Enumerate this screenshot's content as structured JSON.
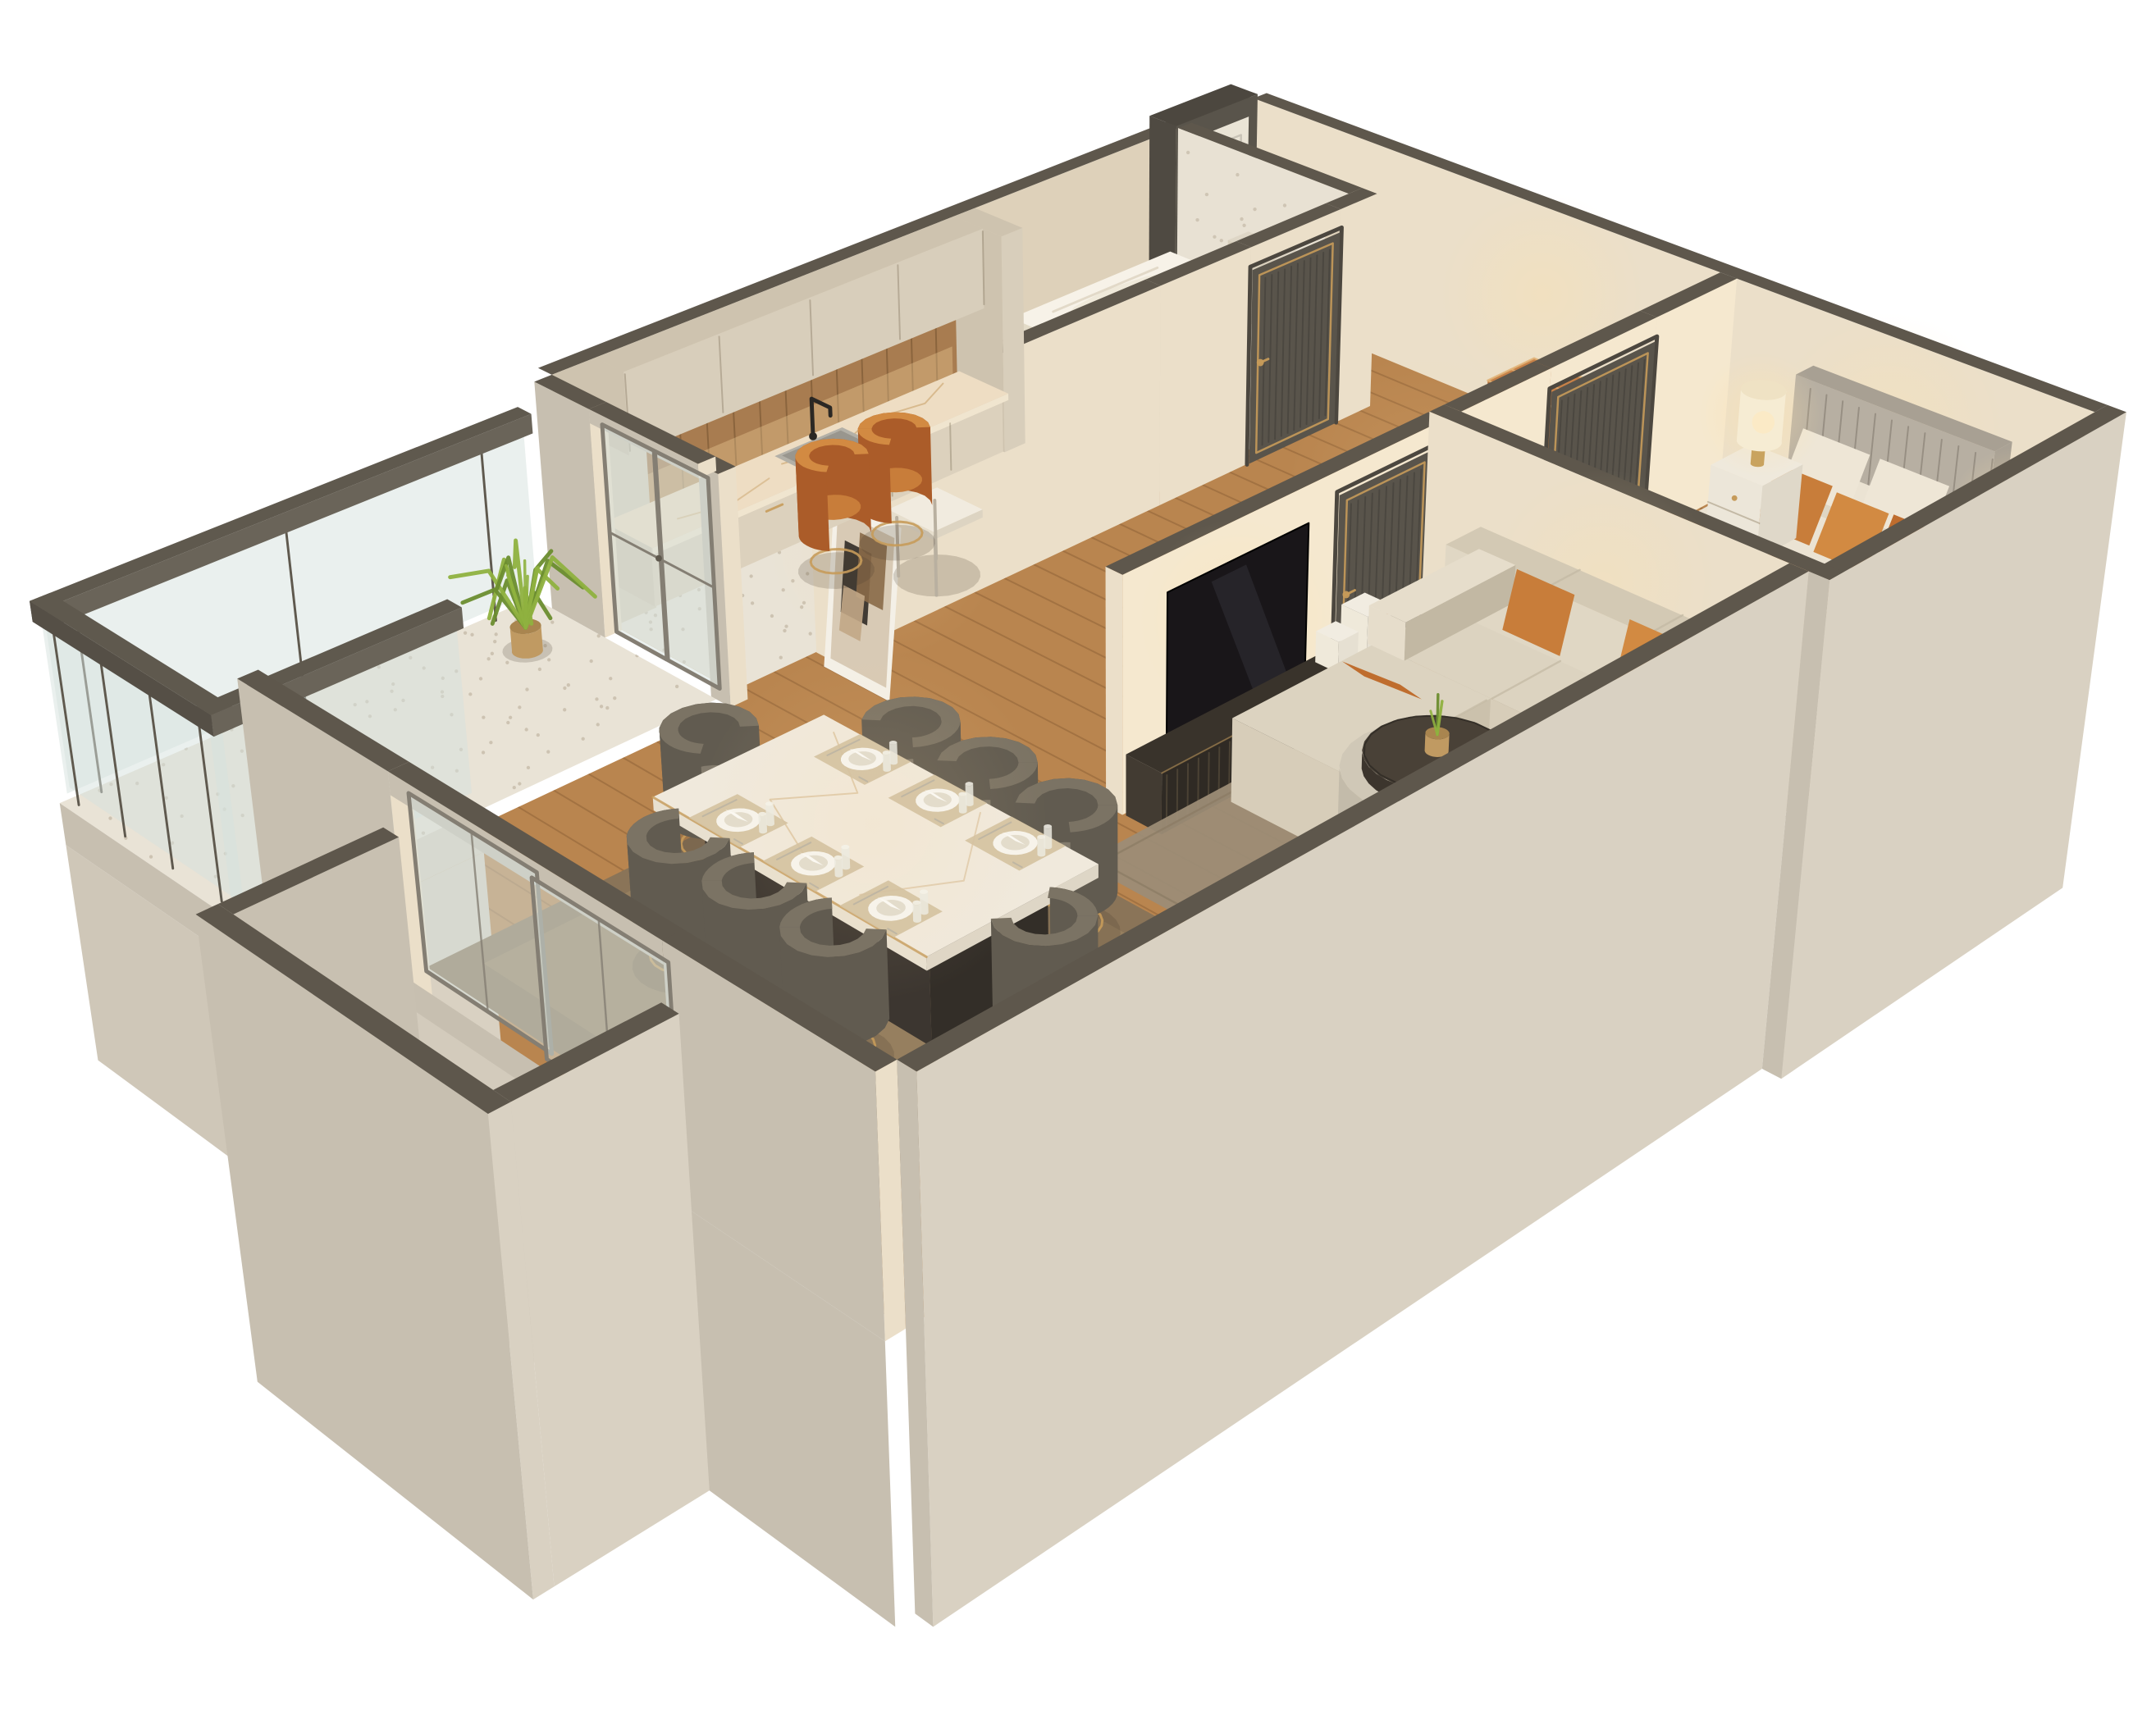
{
  "title": "3D isometric cutaway floor plan render of a one-bedroom apartment",
  "palette": {
    "bg": "#ffffff",
    "wallCap": "#5e574c",
    "extBright": "#d9d1c2",
    "extMid": "#c7bfb0",
    "extDeep": "#cfc7b8",
    "intWall": "#ebdfc9",
    "intWallLit": "#f5e8cf",
    "intWallDim": "#ded1ba",
    "wood": "#b9854f",
    "woodLine": "rgba(96,60,28,0.25)",
    "terrazzo": "#e9e3d6",
    "terrazzoDot": "#b6aa96",
    "rugBed": "#48423a",
    "rugBedLine": "#5f584c",
    "rugLiving": "#9c8c76",
    "rugDining": "#8a7458",
    "rugDiningLight": "#a18a66",
    "doorDark": "#59544b",
    "doorLine": "#49453e",
    "doorFrame": "#4c473f",
    "gold": "#c69b5a",
    "entryDoor": "#eae4d6",
    "glass": "rgba(214,226,222,0.5)",
    "glassFrame": "#847e73",
    "railDark": "#5f594e",
    "white": "#f7f2e8",
    "cream": "#efe9da",
    "marble": "#eeddc3",
    "marbleVein": "#c69d62",
    "counterFace": "#dcd1bd",
    "cabinet": "#d8cebb",
    "cabinetShade": "#cec3af",
    "cabinetLine": "rgba(95,78,55,0.28)",
    "backsplash": "#a87c50",
    "backsplashLine": "rgba(70,45,20,0.3)",
    "sink": "#b3b0a7",
    "sinkInner": "#99968e",
    "black": "#2b2824",
    "ottoman": "#b5713a",
    "ottomanTop": "#c68148",
    "ottomanShade": "#a2602c",
    "pipe": "#e2b478",
    "headboard": "#b7afa2",
    "headboardTop": "#a8a093",
    "headboardLine": "rgba(80,70,58,0.3)",
    "bedBase": "#a29a8c",
    "bedBaseShade": "#948c7e",
    "sheet": "#ebe3d3",
    "sheetShade": "#d9d0bd",
    "sheetDark": "#cfc6b2",
    "duvet": "#c4722f",
    "duvetShade": "#ad6428",
    "duvetDark": "#9d5a24",
    "duvetFold": "#d2823e",
    "pillowWhite": "#eee6d6",
    "pillowWhiteShade": "#dcd2bf",
    "orange1": "#c87d3a",
    "orange2": "#d28a42",
    "orange3": "#bf6d2e",
    "orangeChairSide": "#ab5c29",
    "nightstand": "#ece6d9",
    "nightstandShade": "#dfd8c9",
    "lampBase": "#c9a35f",
    "lampShade": "#f6ecd3",
    "lampShadeTop": "#efe2c4",
    "glow": "#ffe2aa",
    "sofa": "#dcd3c0",
    "sofaLight": "#e6ddcb",
    "sofaShade": "#cbc1ac",
    "sofaDark": "#c2b8a3",
    "knitLine": "rgba(120,108,88,0.35)",
    "pouf": "#98937e",
    "poufTop": "#a7a28d",
    "coffeeBase": "#c3bbaa",
    "coffeeBaseTop": "#d0c8b7",
    "coffeeTop": "#494137",
    "coffeeTopSide": "#3c352d",
    "tv": "#191619",
    "console": "#39332b",
    "consoleFace": "#2f2a24",
    "consoleLine": "rgba(205,175,125,0.18)",
    "books": "#f1ece1",
    "artFrame": "#f4f0e7",
    "artBg": "#d8cab5",
    "artDark": "#342f29",
    "artBrown": "#8a6a48",
    "artTan": "#c2a786",
    "chairRing": "#7b7364",
    "chairSide": "#615b50",
    "chairSeat": "#837b6d",
    "tableBase": "#3c3630",
    "tableBaseSide": "#332e28",
    "tableTop": "#f0e9dc",
    "tableTopShade": "#ded6c6",
    "plate": "#f7f3ea",
    "plateRim": "#e3dccb",
    "placemat": "#d5c2a1",
    "plantGreen": "#8fb13f",
    "plantDark": "#6b8d2f",
    "pot": "#c09a62",
    "potTop": "#a9854f",
    "shadow": "rgba(70,58,44,0.20)"
  },
  "scene": {
    "rooms": [
      {
        "name": "entry-hallway"
      },
      {
        "name": "bathroom"
      },
      {
        "name": "kitchen"
      },
      {
        "name": "bedroom"
      },
      {
        "name": "living-room"
      },
      {
        "name": "dining-area"
      },
      {
        "name": "balcony"
      },
      {
        "name": "window-bay"
      }
    ],
    "objects": [
      "entry-door",
      "bathroom-door",
      "bedroom-door",
      "living-room-door",
      "bathtub",
      "toilet",
      "gold-flush-plate",
      "kitchen-counter",
      "kitchen-sink",
      "black-faucet",
      "upper-cabinets",
      "wood-backsplash",
      "breakfast-table",
      "orange-chairs",
      "leather-ottoman",
      "framed-abstract-art",
      "tv",
      "tv-console",
      "white-books",
      "bed",
      "gray-headboard",
      "orange-duvet",
      "orange-pillows",
      "white-pillows",
      "nightstands",
      "table-lamps",
      "bedroom-rug",
      "sectional-sofa",
      "orange-lumbar-pillows",
      "round-coffee-table",
      "mini-plant",
      "pouf",
      "dining-table",
      "place-settings",
      "velvet-dining-chairs",
      "sliding-window",
      "balcony-glass-railing",
      "potted-fern"
    ]
  }
}
